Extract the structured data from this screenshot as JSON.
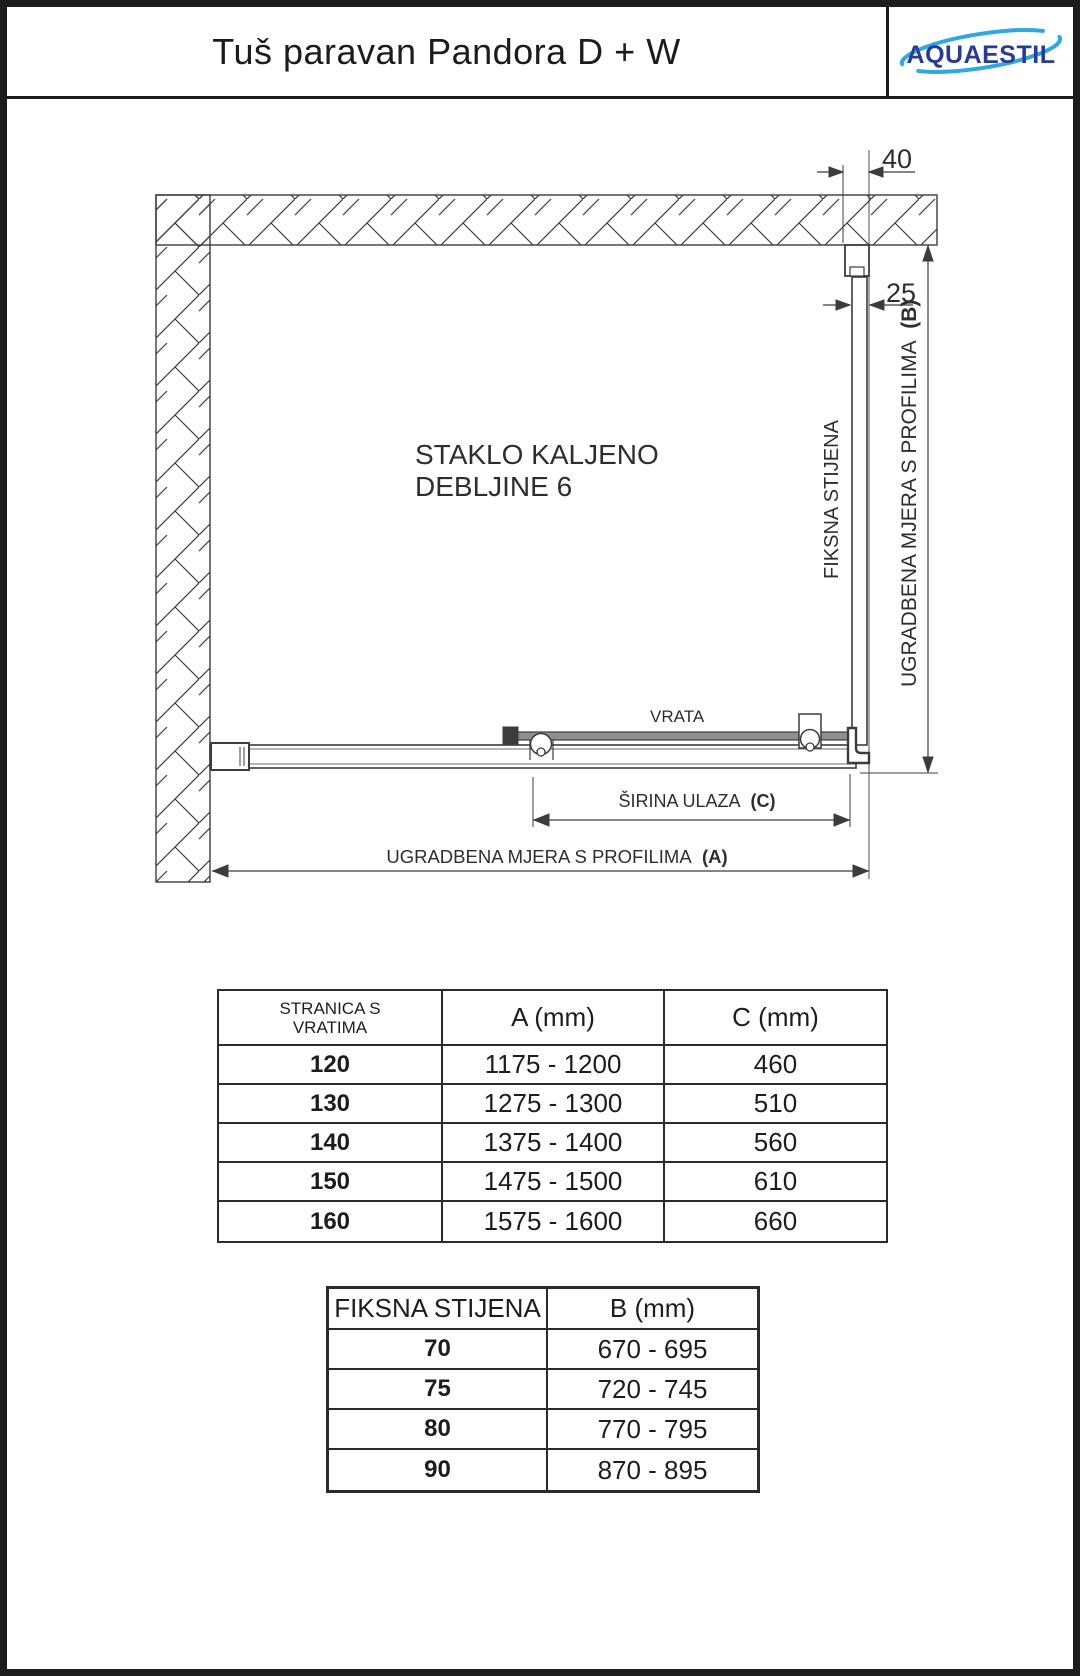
{
  "header": {
    "title": "Tuš paravan Pandora D + W",
    "logo_text": "AQUAESTIL"
  },
  "drawing": {
    "glass_note_line1": "STAKLO KALJENO",
    "glass_note_line2": "DEBLJINE 6",
    "door_label": "VRATA",
    "fixed_panel_label": "FIKSNA STIJENA",
    "dim_40": "40",
    "dim_25": "25",
    "dim_b_text": "UGRADBENA MJERA S PROFILIMA",
    "dim_b_suffix": "(B)",
    "dim_c_text": "ŠIRINA ULAZA",
    "dim_c_suffix": "(C)",
    "dim_a_text": "UGRADBENA MJERA S PROFILIMA",
    "dim_a_suffix": "(A)"
  },
  "tables": {
    "door_side": {
      "headers": {
        "col1_line1": "STRANICA S",
        "col1_line2": "VRATIMA",
        "col2": "A (mm)",
        "col3": "C (mm)"
      },
      "rows": [
        {
          "size": "120",
          "a": "1175 - 1200",
          "c": "460"
        },
        {
          "size": "130",
          "a": "1275 - 1300",
          "c": "510"
        },
        {
          "size": "140",
          "a": "1375 - 1400",
          "c": "560"
        },
        {
          "size": "150",
          "a": "1475 - 1500",
          "c": "610"
        },
        {
          "size": "160",
          "a": "1575 - 1600",
          "c": "660"
        }
      ]
    },
    "fixed_panel": {
      "headers": {
        "col1": "FIKSNA STIJENA",
        "col2": "B (mm)"
      },
      "rows": [
        {
          "size": "70",
          "b": "670 - 695"
        },
        {
          "size": "75",
          "b": "720 - 745"
        },
        {
          "size": "80",
          "b": "770 - 795"
        },
        {
          "size": "90",
          "b": "870 - 895"
        }
      ]
    }
  },
  "colors": {
    "line": "#3c3c3c",
    "logo_blue": "#2b3a92",
    "logo_swoosh": "#2fa8e1"
  }
}
